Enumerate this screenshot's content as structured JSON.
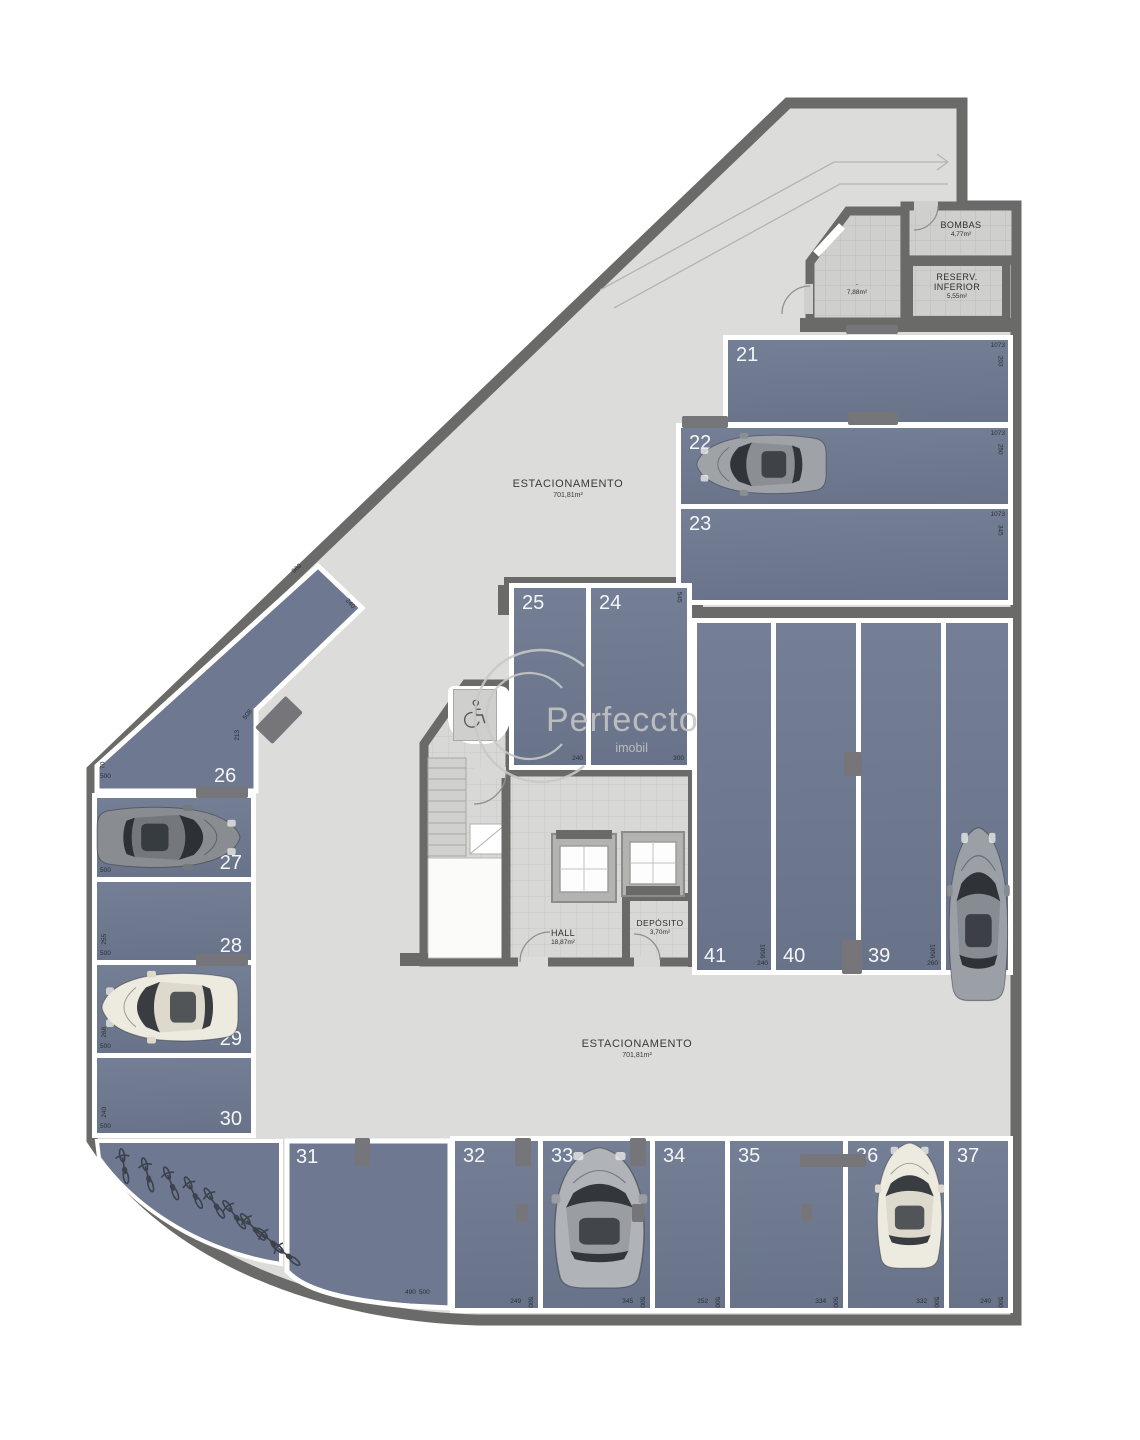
{
  "plan": {
    "watermark": {
      "name": "Perfeccto",
      "sub": "imobil"
    },
    "estacionamento": {
      "label": "ESTACIONAMENTO",
      "area": "701,81m²"
    },
    "rooms": {
      "bombas": {
        "name": "BOMBAS",
        "area": "4,77m²"
      },
      "reserv": {
        "line1": "RESERV.",
        "line2": "INFERIOR",
        "area": "5,55m²"
      },
      "small": {
        "name": "-",
        "area": "7,88m²"
      },
      "hall": {
        "name": "HALL",
        "area": "18,87m²"
      },
      "deposito": {
        "name": "DEPÓSITO",
        "area": "3,70m²"
      }
    },
    "colors": {
      "bay": "#6e7890",
      "wall": "#6a6a68",
      "floor": "#dcdcda",
      "divider": "#ffffff"
    },
    "spaces": [
      {
        "id": "21",
        "len": "1073",
        "dep": "203"
      },
      {
        "id": "22",
        "len": "1073",
        "dep": "250"
      },
      {
        "id": "23",
        "len": "1073",
        "dep": "345"
      },
      {
        "id": "24",
        "len": "300",
        "dep": "545"
      },
      {
        "id": "25",
        "len": "240"
      },
      {
        "id": "26",
        "len": "500",
        "dep": "70",
        "edge": "960",
        "end": "240",
        "side": "508",
        "side2": "213"
      },
      {
        "id": "27",
        "len": "500",
        "dep": "240"
      },
      {
        "id": "28",
        "len": "500",
        "dep": "255"
      },
      {
        "id": "29",
        "len": "500",
        "dep": "268"
      },
      {
        "id": "30",
        "len": "500",
        "dep": "240"
      },
      {
        "id": "31",
        "len": "490",
        "dep": "500"
      },
      {
        "id": "32",
        "len": "249",
        "dep": "500"
      },
      {
        "id": "33",
        "len": "345",
        "dep": "500"
      },
      {
        "id": "34",
        "len": "252",
        "dep": "500"
      },
      {
        "id": "35",
        "len": "334",
        "dep": "500"
      },
      {
        "id": "36",
        "len": "332",
        "dep": "500"
      },
      {
        "id": "37",
        "len": "240",
        "dep": "500"
      },
      {
        "id": "38",
        "len": "1056",
        "dep": "263"
      },
      {
        "id": "39",
        "len": "1056",
        "dep": "260"
      },
      {
        "id": "40",
        "len": "1056",
        "dep": "260"
      },
      {
        "id": "41",
        "len": "1056",
        "dep": "240"
      }
    ]
  }
}
